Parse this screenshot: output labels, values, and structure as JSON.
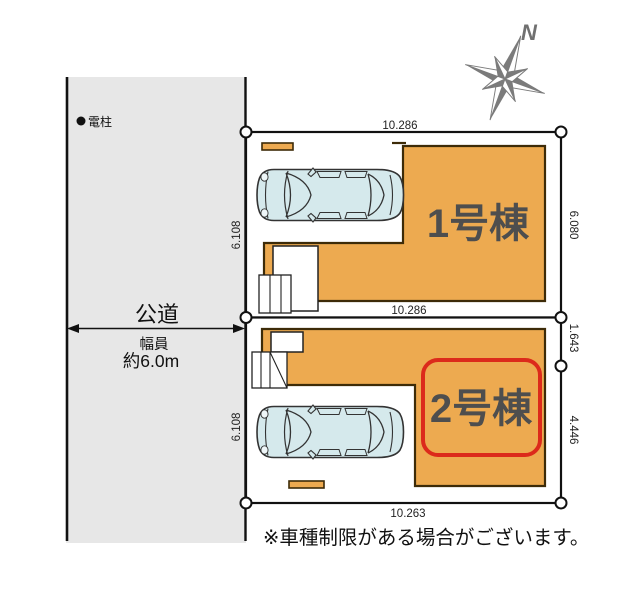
{
  "colors": {
    "building_fill": "#edaa50",
    "building_outline": "#3d2b08",
    "highlight_red": "#dc2a1b",
    "road_fill": "#e7e7e7",
    "car_fill": "#d5e9ec",
    "line_black": "#111111",
    "label_gray": "#4e4e4e",
    "compass_gray": "#7b7b7b"
  },
  "compass": {
    "north_label": "N"
  },
  "road": {
    "pole_label": "電柱",
    "name": "公道",
    "width_caption": "幅員",
    "width_value": "約6.0m"
  },
  "lot1": {
    "building_label": "1号棟",
    "dim_top": "10.286",
    "dim_left": "6.108",
    "dim_right": "6.080"
  },
  "lot2": {
    "building_label": "2号棟",
    "dim_top": "10.286",
    "dim_left": "6.108",
    "dim_right_upper": "1.643",
    "dim_right_lower": "4.446",
    "dim_bottom": "10.263"
  },
  "note": {
    "text": "※車種制限がある場合がございます。"
  }
}
